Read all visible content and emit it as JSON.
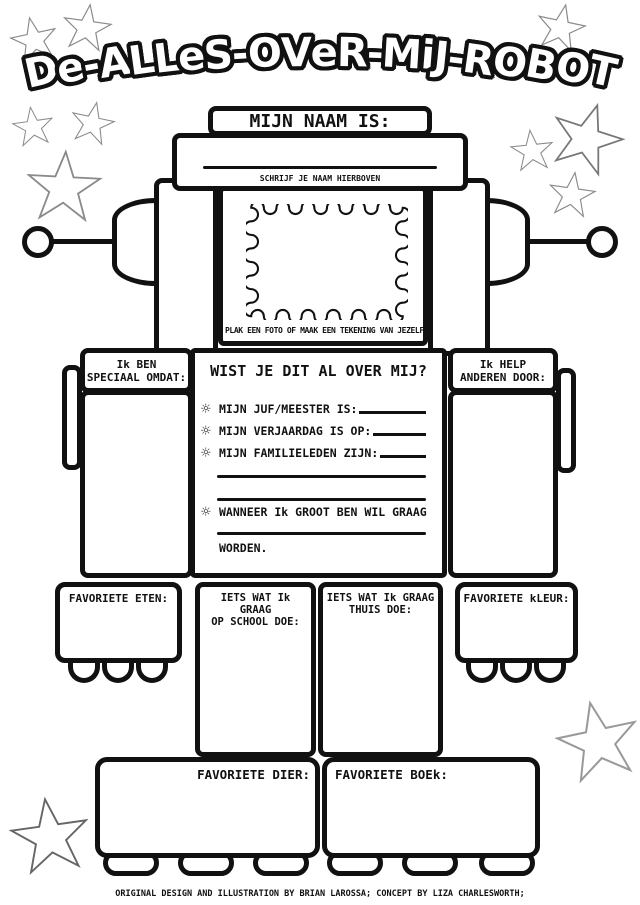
{
  "title": "De-ALLeS-OVeR-MiJ-ROBOT",
  "name_section": {
    "header": "MIJN NAAM IS:",
    "caption": "SCHRIJF JE NAAM HIERBOVEN"
  },
  "photo_section": {
    "caption": "PLAK EEN FOTO OF MAAK EEN TEKENING VAN JEZELF"
  },
  "left_arm": {
    "line1": "Ik BEN",
    "line2": "SPECIAAL OMDAT:"
  },
  "right_arm": {
    "line1": "Ik HELP",
    "line2": "ANDEREN DOOR:"
  },
  "torso": {
    "header": "WIST JE DIT AL OVER MIJ?",
    "bullet_icon": "☼",
    "items": [
      {
        "label": "MIJN JUF/MEESTER IS:"
      },
      {
        "label": "MIJN VERJAARDAG IS OP:"
      },
      {
        "label": "MIJN FAMILIELEDEN ZIJN:"
      }
    ],
    "wish_label": "WANNEER Ik GROOT BEN WIL GRAAG",
    "wish_suffix": "WORDEN."
  },
  "left_hand": {
    "label": "FAVORIETE ETEN:"
  },
  "left_leg": {
    "line1": "IETS WAT Ik GRAAG",
    "line2": "OP SCHOOL DOE:"
  },
  "right_leg": {
    "line1": "IETS WAT Ik GRAAG",
    "line2": "THUIS DOE:"
  },
  "right_hand": {
    "label": "FAVORIETE kLEUR:"
  },
  "left_foot": {
    "label": "FAVORIETE DIER:"
  },
  "right_foot": {
    "label": "FAVORIETE BOEk:"
  },
  "footer": "ORIGINAL DESIGN AND ILLUSTRATION BY BRIAN LAROSSA; CONCEPT BY LIZA CHARLESWORTH;",
  "colors": {
    "ink": "#111111",
    "paper": "#ffffff",
    "star_outline": "#8a8a8a"
  }
}
